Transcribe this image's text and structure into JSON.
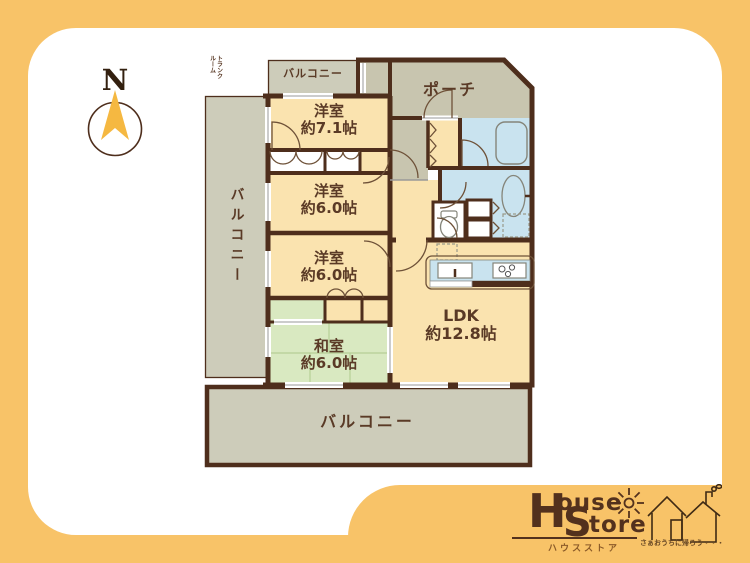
{
  "compass": {
    "north_label": "N"
  },
  "plan": {
    "balcony_top": {
      "label": "バルコニー"
    },
    "trunk_room": {
      "label": "トランクルーム",
      "line1": "トランク",
      "line2": "ルーム"
    },
    "porch": {
      "label": "ポーチ"
    },
    "western_room_1": {
      "name": "洋室",
      "size": "約7.1帖"
    },
    "western_room_2": {
      "name": "洋室",
      "size": "約6.0帖"
    },
    "western_room_3": {
      "name": "洋室",
      "size": "約6.0帖"
    },
    "japanese_room": {
      "name": "和室",
      "size": "約6.0帖"
    },
    "ldk": {
      "name": "LDK",
      "size": "約12.8帖"
    },
    "balcony_left": {
      "label": "バルコニー"
    },
    "balcony_bottom": {
      "label": "バルコニー"
    }
  },
  "logo": {
    "brand_line1_initial": "H",
    "brand_line1_rest": "ouse",
    "brand_line2_initial": "S",
    "brand_line2_rest": "tore",
    "brand_katakana": "ハウスストア",
    "tagline": "さぁおうちに帰ろう・・・"
  },
  "colors": {
    "frame_yellow": "#F8C368",
    "wall_brown": "#4E2E1C",
    "text_brown": "#5A3A26",
    "room_cream": "#FAE3AF",
    "balcony_gray": "#CDCCBA",
    "porch_khaki": "#C8C5AF",
    "water_blue": "#C9E3EF",
    "tatami_green": "#D9E9C1",
    "compass_arrow": "#F5B841"
  }
}
